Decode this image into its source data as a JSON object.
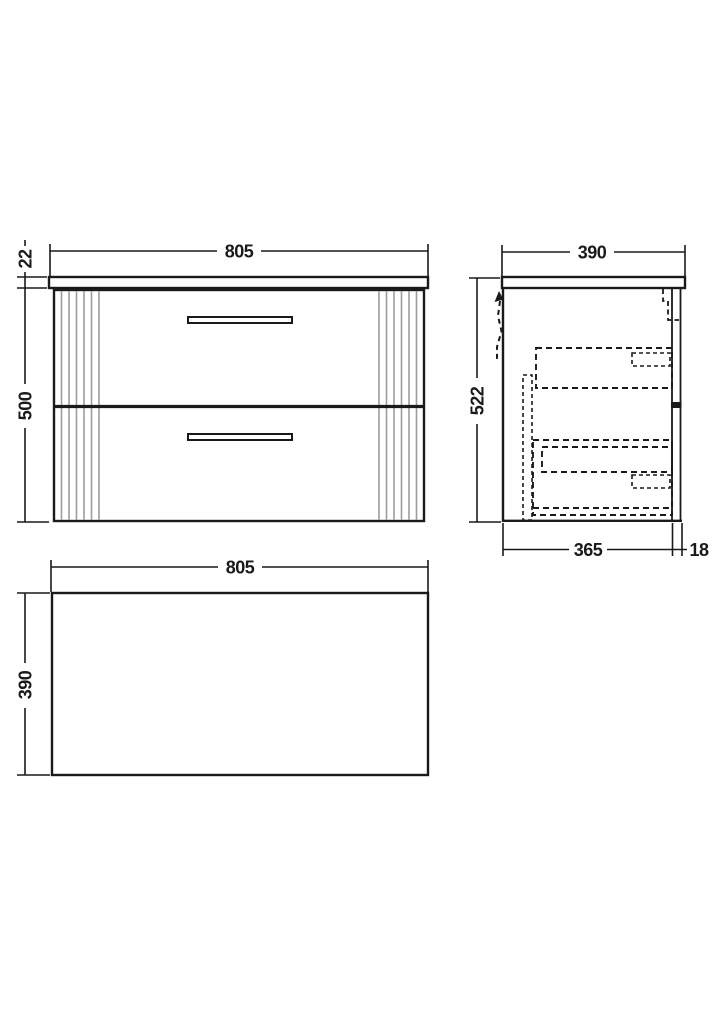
{
  "front_view": {
    "width_mm": "805",
    "worktop_thickness_mm": "22",
    "cabinet_height_mm": "500"
  },
  "side_view": {
    "depth_mm": "390",
    "overall_height_mm": "522",
    "cabinet_depth_mm": "365",
    "back_panel_mm": "18"
  },
  "plan_view": {
    "width_mm": "805",
    "depth_mm": "390"
  },
  "colors": {
    "line": "#1a1a1a",
    "flute": "#9c9c9c",
    "background": "#ffffff"
  }
}
